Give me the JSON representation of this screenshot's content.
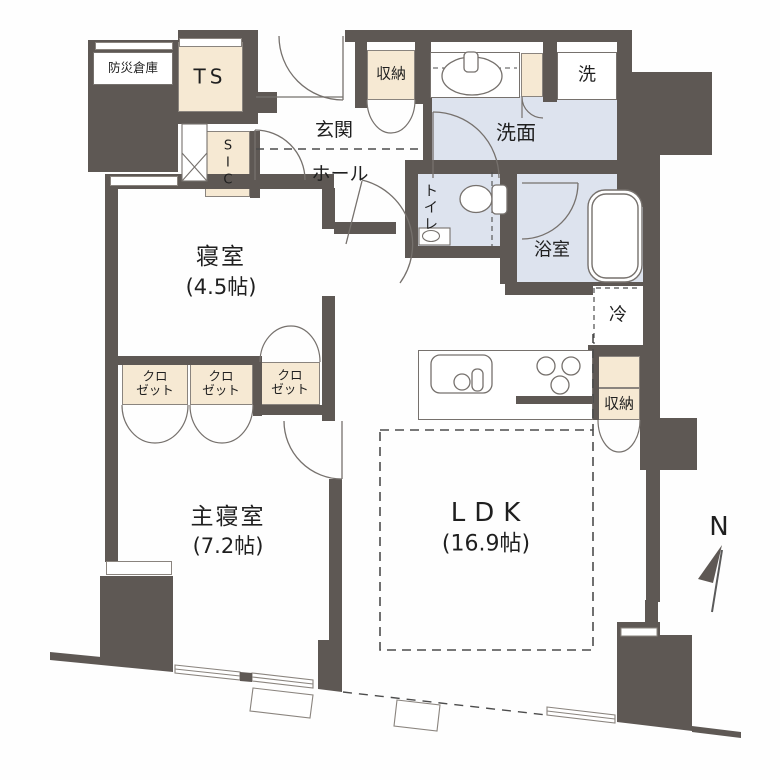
{
  "plan": {
    "rooms": {
      "bedroom": {
        "name": "寝室",
        "size": "(4.5帖)"
      },
      "master_bedroom": {
        "name": "主寝室",
        "size": "(7.2帖)"
      },
      "ldk": {
        "name": "LDK",
        "size": "(16.9帖)"
      }
    },
    "labels": {
      "disaster_storage": "防災倉庫",
      "trunk_space": "TS",
      "shoe_closet": "SIC",
      "entrance": "玄関",
      "hall": "ホール",
      "hall_storage": "収納",
      "laundry": "洗",
      "washroom": "洗面",
      "toilet": "トイレ",
      "bathroom": "浴室",
      "refrigerator": "冷",
      "kitchen_storage": "収納",
      "compass_north": "N"
    },
    "closets": [
      {
        "line1": "クロ",
        "line2": "ゼット"
      },
      {
        "line1": "クロ",
        "line2": "ゼット"
      },
      {
        "line1": "クロ",
        "line2": "ゼット"
      }
    ],
    "colors": {
      "wall": "#5e5854",
      "storage_fill": "#f6e9d3",
      "wet_area_fill": "#dde3ee",
      "outline": "#76716d"
    }
  }
}
